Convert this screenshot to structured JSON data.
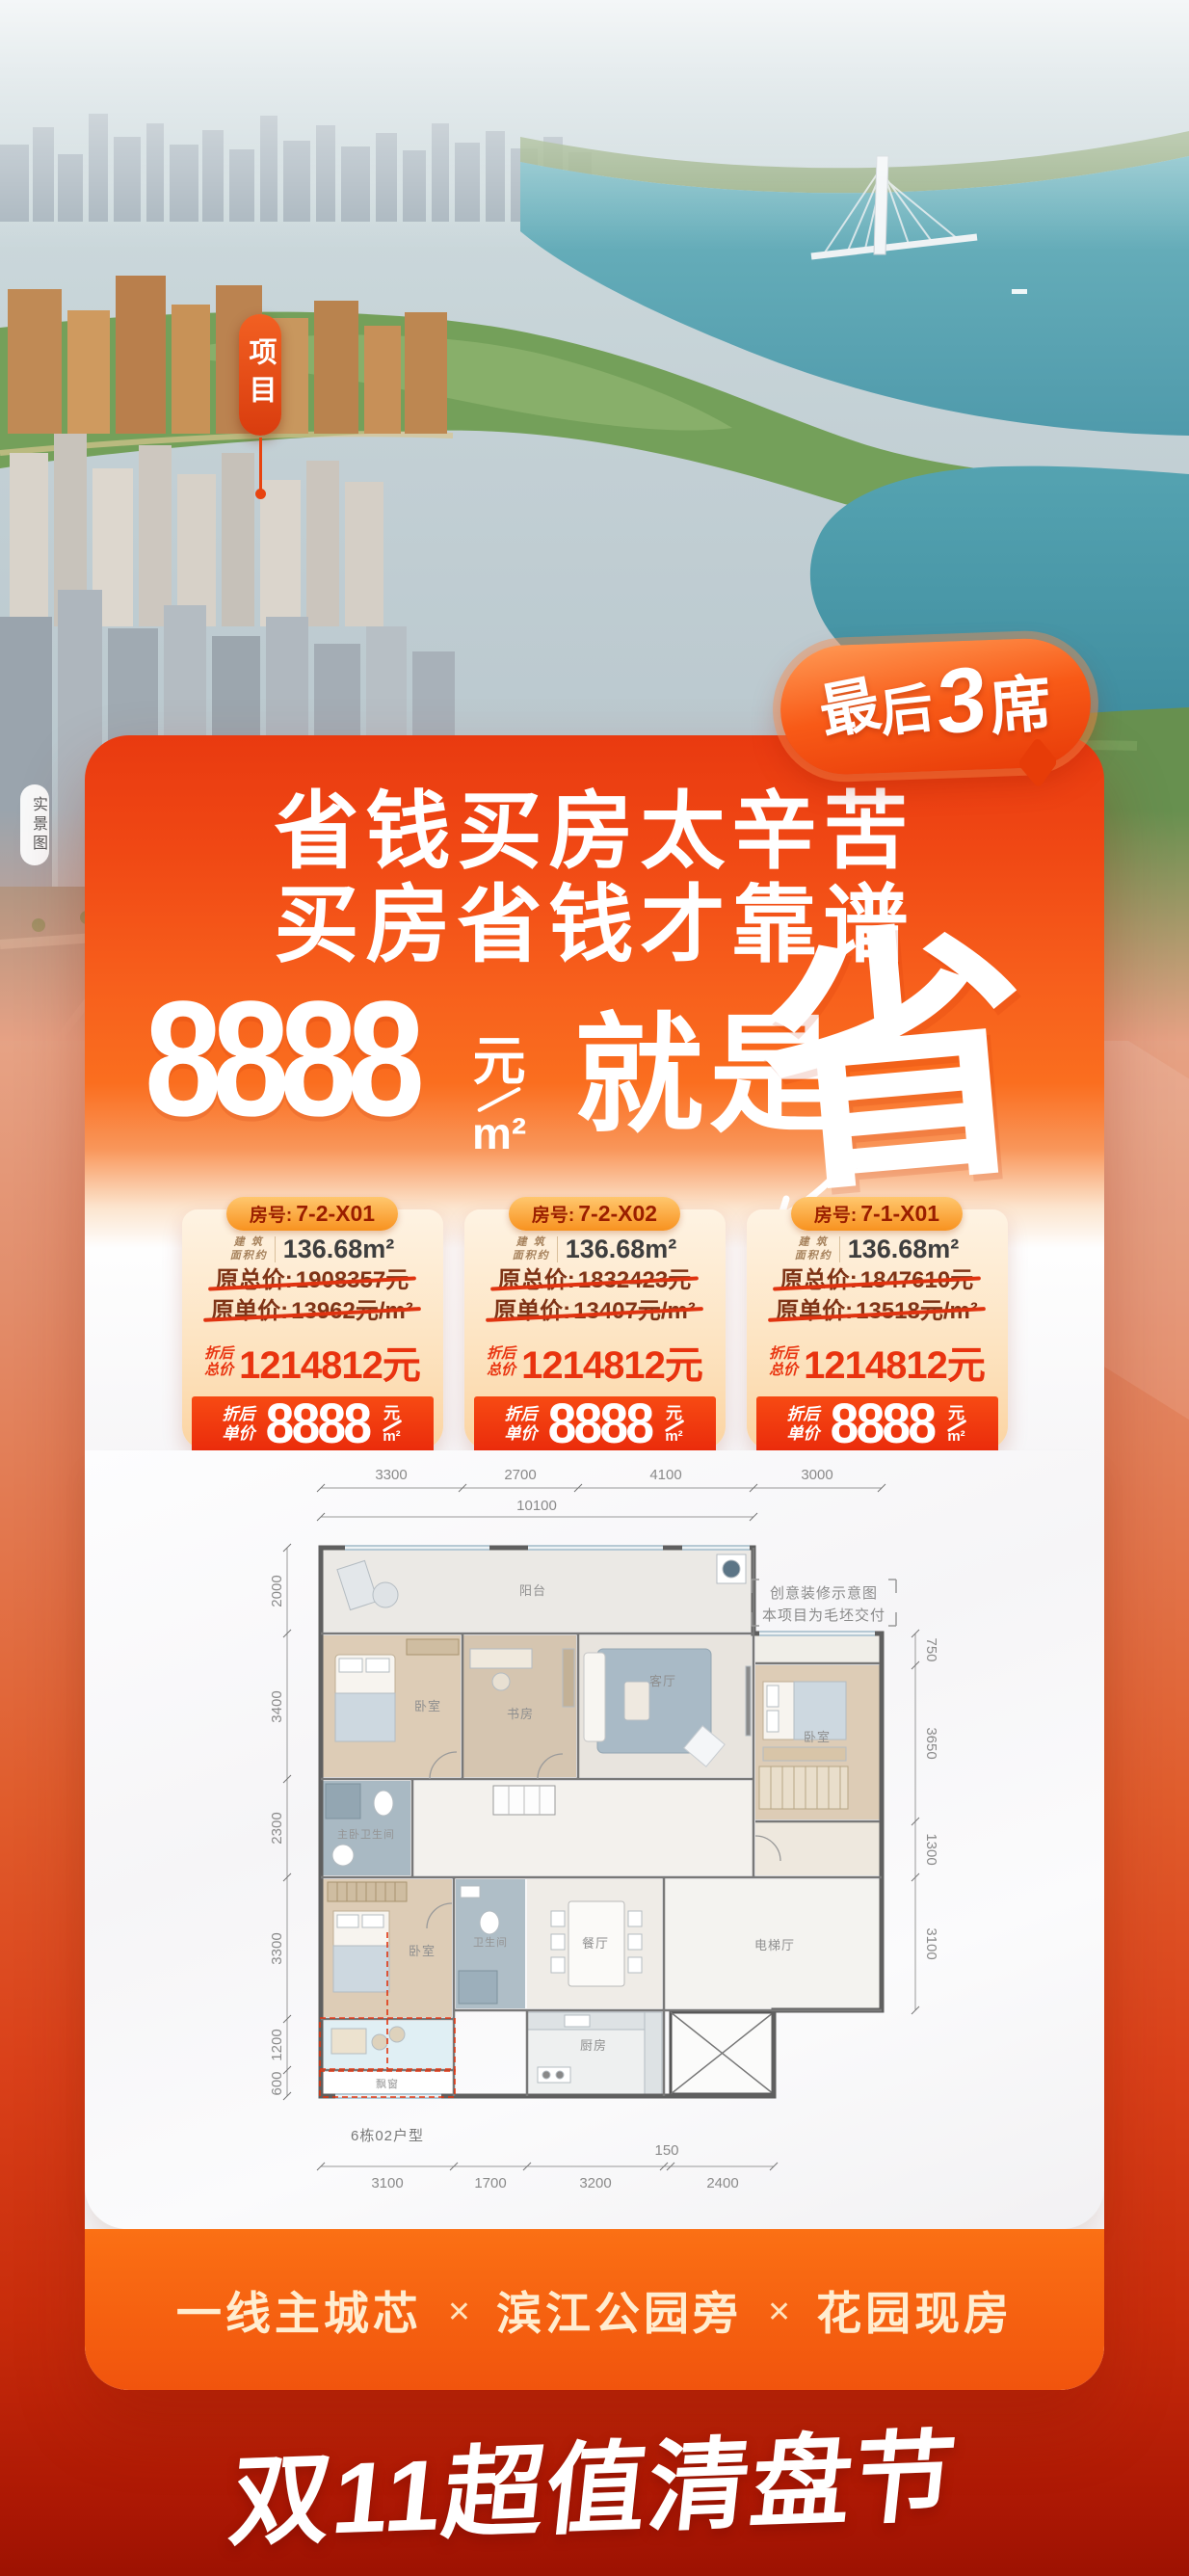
{
  "photo": {
    "project_tag": "项目",
    "watermark": "实景图"
  },
  "badge": {
    "chars": [
      "最",
      "后",
      "3",
      "席"
    ]
  },
  "headline": {
    "line1": "省钱买房太辛苦",
    "line2": "买房省钱才靠谱"
  },
  "banner": {
    "number": "8888",
    "yuan": "元",
    "sqm": "m²",
    "phrase": "就是",
    "calligraphy": "省"
  },
  "units": [
    {
      "room_label": "房号:",
      "room_no": "7-2-X01",
      "area_label_top": "建 筑",
      "area_label_bottom": "面积约",
      "area_value": "136.68m²",
      "orig_total_label": "原总价:",
      "orig_total_value": "1908357元",
      "orig_unit_label": "原单价:",
      "orig_unit_value": "13962元/m²",
      "disc_total_label_top": "折后",
      "disc_total_label_bottom": "总价",
      "disc_total_value": "1214812元",
      "disc_unit_label_top": "折后",
      "disc_unit_label_bottom": "单价",
      "disc_unit_number": "8888",
      "disc_unit_yuan": "元",
      "disc_unit_sqm": "m²"
    },
    {
      "room_label": "房号:",
      "room_no": "7-2-X02",
      "area_label_top": "建 筑",
      "area_label_bottom": "面积约",
      "area_value": "136.68m²",
      "orig_total_label": "原总价:",
      "orig_total_value": "1832423元",
      "orig_unit_label": "原单价:",
      "orig_unit_value": "13407元/m²",
      "disc_total_label_top": "折后",
      "disc_total_label_bottom": "总价",
      "disc_total_value": "1214812元",
      "disc_unit_label_top": "折后",
      "disc_unit_label_bottom": "单价",
      "disc_unit_number": "8888",
      "disc_unit_yuan": "元",
      "disc_unit_sqm": "m²"
    },
    {
      "room_label": "房号:",
      "room_no": "7-1-X01",
      "area_label_top": "建 筑",
      "area_label_bottom": "面积约",
      "area_value": "136.68m²",
      "orig_total_label": "原总价:",
      "orig_total_value": "1847610元",
      "orig_unit_label": "原单价:",
      "orig_unit_value": "13518元/m²",
      "disc_total_label_top": "折后",
      "disc_total_label_bottom": "总价",
      "disc_total_value": "1214812元",
      "disc_unit_label_top": "折后",
      "disc_unit_label_bottom": "单价",
      "disc_unit_number": "8888",
      "disc_unit_yuan": "元",
      "disc_unit_sqm": "m²"
    }
  ],
  "floorplan": {
    "note_line1": "创意装修示意图",
    "note_line2": "本项目为毛坯交付",
    "unit_type": "6栋02户型",
    "dims_top": [
      "3300",
      "2700",
      "4100",
      "3000"
    ],
    "dim_total": "10100",
    "dims_left": [
      "2000",
      "3400",
      "2300",
      "3300",
      "1200",
      "600"
    ],
    "dims_right": [
      "750",
      "3650",
      "1300",
      "3100"
    ],
    "dims_bottom": [
      "3100",
      "1700",
      "3200",
      "150",
      "2400"
    ],
    "rooms": {
      "balcony": "阳台",
      "bedroom_top_left": "卧室",
      "study": "书房",
      "living": "客厅",
      "bedroom_right": "卧室",
      "master_bath": "主卧卫生间",
      "bedroom_bottom": "卧室",
      "bath": "卫生间",
      "dining": "餐厅",
      "elevator_hall": "电梯厅",
      "kitchen": "厨房",
      "bay_window": "飘窗"
    }
  },
  "sellpoints": {
    "items": [
      "一线主城芯",
      "滨江公园旁",
      "花园现房"
    ],
    "separator": "✕"
  },
  "event_title": "双11超值清盘节",
  "colors": {
    "primary_red": "#e8380f",
    "orange": "#f8651c",
    "peach_card": "#fbd6a6",
    "deep_red_bottom": "#a01403",
    "water_teal": "#5ba4b2"
  }
}
